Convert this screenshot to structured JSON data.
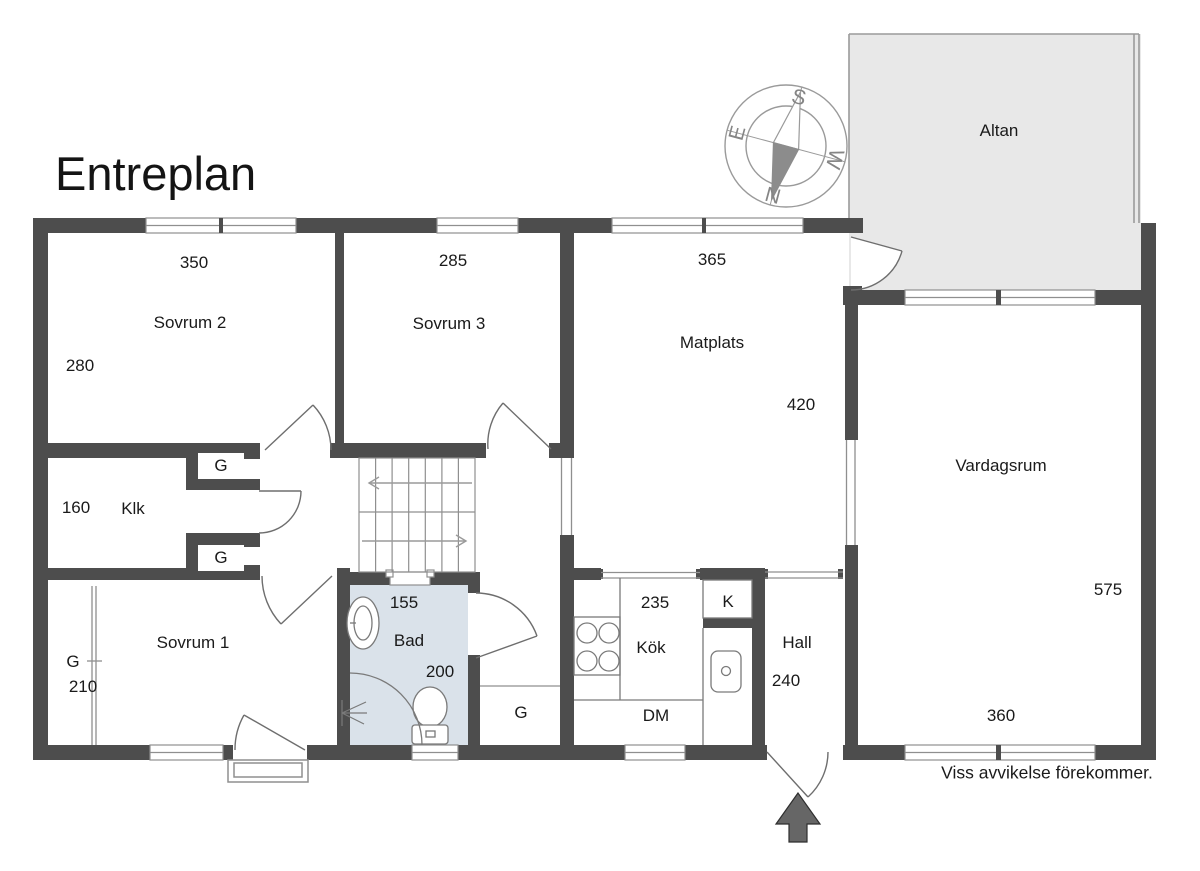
{
  "title": "Entreplan",
  "disclaimer": "Viss avvikelse förekommer.",
  "compass": {
    "n": "N",
    "e": "E",
    "s": "S",
    "w": "W"
  },
  "labels": {
    "g": "G",
    "k": "K",
    "dm": "DM"
  },
  "rooms": {
    "altan": {
      "name": "Altan"
    },
    "sovrum2": {
      "name": "Sovrum 2",
      "d1": "350",
      "d2": "280"
    },
    "sovrum3": {
      "name": "Sovrum 3",
      "d1": "285"
    },
    "matplats": {
      "name": "Matplats",
      "d1": "365",
      "d2": "420"
    },
    "vardagsrum": {
      "name": "Vardagsrum",
      "d1": "575",
      "d2": "360"
    },
    "klk": {
      "name": "Klk",
      "d1": "160"
    },
    "sovrum1": {
      "name": "Sovrum 1",
      "d1": "210"
    },
    "bad": {
      "name": "Bad",
      "d1": "155",
      "d2": "200"
    },
    "kok": {
      "name": "Kök",
      "d1": "235"
    },
    "hall": {
      "name": "Hall",
      "d1": "240"
    }
  },
  "colors": {
    "wall": "#4d4d4d",
    "bath_fill": "#dae2ea",
    "deck_fill": "#e8e8e8",
    "line": "#8f8f8f"
  }
}
